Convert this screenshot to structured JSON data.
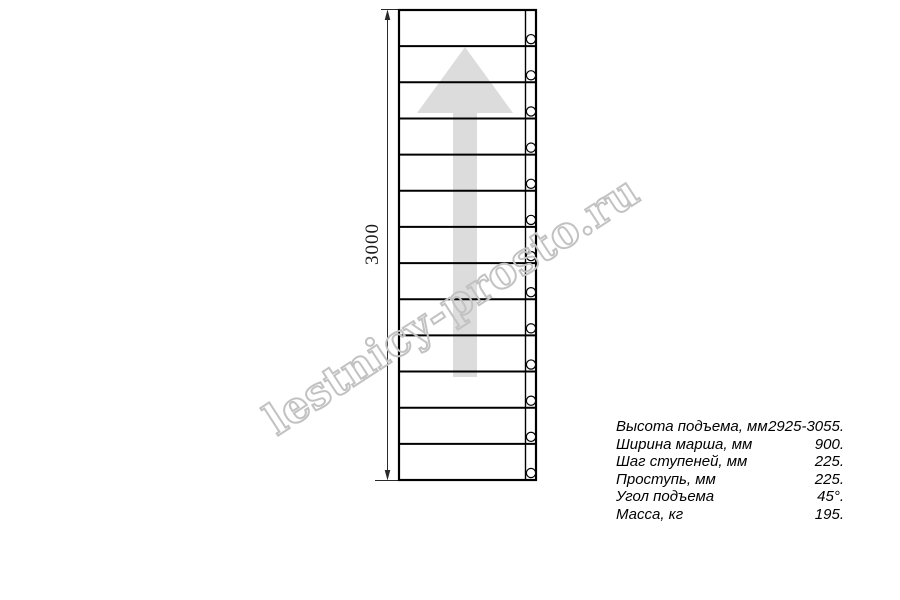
{
  "drawing": {
    "dimension_label": "3000",
    "treads_count": 13,
    "holes_count": 13,
    "direction": "up"
  },
  "watermark": {
    "text": "lestnicy-prosto.ru",
    "color": "#c2c2c2"
  },
  "specs": {
    "rows": [
      {
        "label": "Высота подъема, мм",
        "value": "2925-3055."
      },
      {
        "label": "Ширина марша, мм",
        "value": "900."
      },
      {
        "label": "Шаг ступеней, мм",
        "value": "225."
      },
      {
        "label": "Проступь, мм",
        "value": "225."
      },
      {
        "label": "Угол подъема",
        "value": "45°."
      },
      {
        "label": "Масса, кг",
        "value": "195."
      }
    ]
  },
  "colors": {
    "line": "#000000",
    "dimension_line": "#2a2a2a",
    "arrow_fill": "#dcdcdc",
    "watermark_stroke": "#c2c2c2"
  }
}
